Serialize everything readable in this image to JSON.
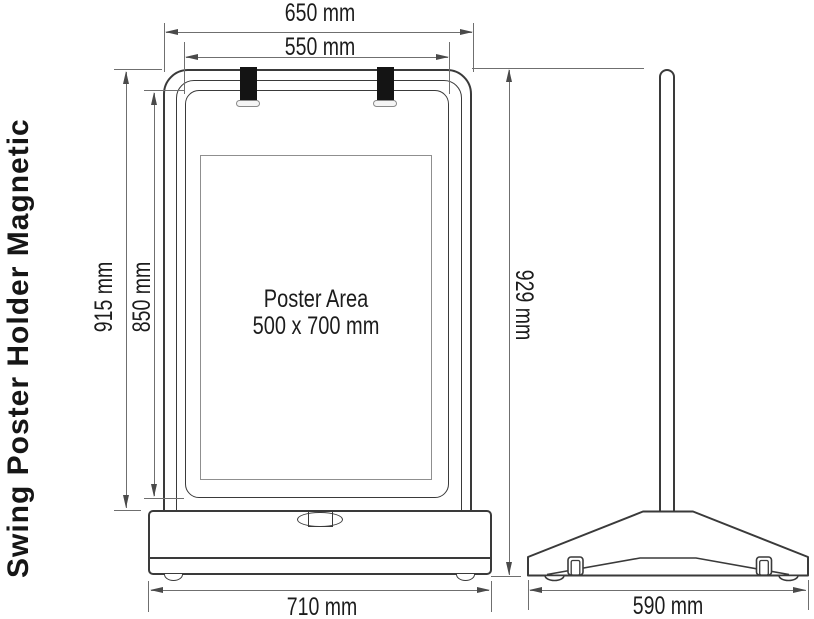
{
  "title": "Swing Poster Holder Magnetic",
  "views": {
    "front": {
      "poster_area": {
        "line1": "Poster Area",
        "line2": "500 x 700 mm"
      },
      "dimensions": {
        "outer_width": "650 mm",
        "panel_width": "550 mm",
        "frame_height": "915 mm",
        "panel_height": "850 mm",
        "base_width": "710 mm"
      }
    },
    "side": {
      "dimensions": {
        "total_height": "929 mm",
        "base_depth": "590 mm"
      }
    }
  },
  "colors": {
    "drawing_line": "#3a3a3a",
    "dimension_line": "#6f6f6f",
    "text": "#1c1c1c",
    "strap": "#141414",
    "background": "#ffffff"
  }
}
